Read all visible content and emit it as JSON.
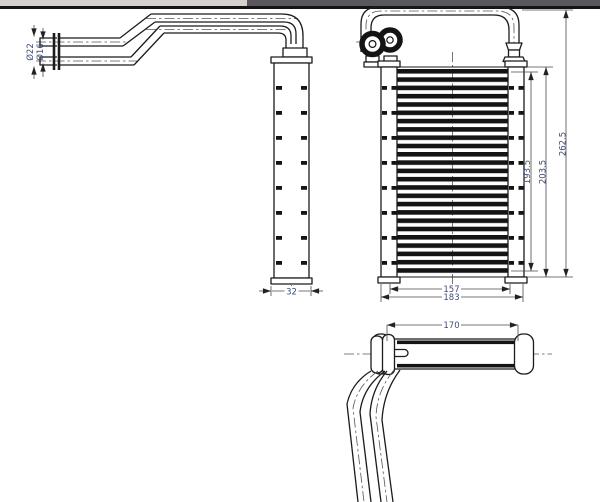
{
  "window": {
    "topbar_left_color": "#d6d2cb",
    "topbar_right_color": "#59585d",
    "divider_color": "#141414"
  },
  "drawing": {
    "type": "technical-drawing",
    "line_color": "#1b1b1b",
    "dim_text_color": "#3f4c78",
    "dimensions": {
      "pipe_outer_diameter": "Ø22",
      "pipe_inner_diameter": "Ø16",
      "tank_depth": "32",
      "core_height": "193.5",
      "tank_height": "203.5",
      "overall_height": "262.5",
      "core_width": "157",
      "overall_width": "183",
      "top_view_width": "170"
    }
  }
}
